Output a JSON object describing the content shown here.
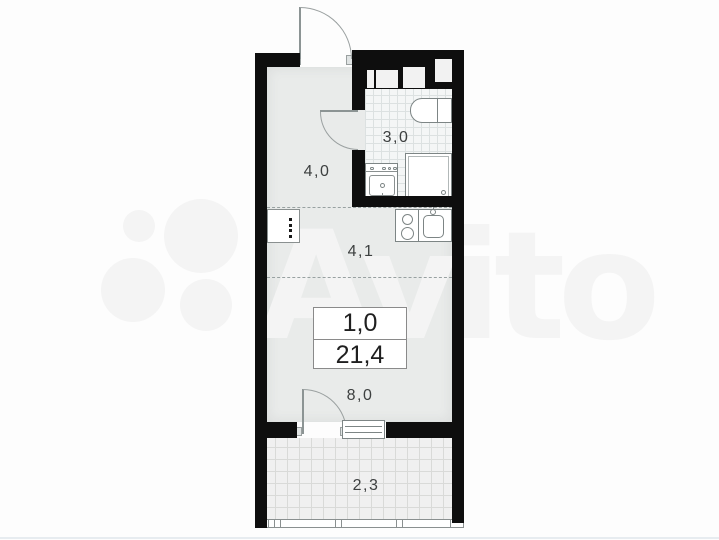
{
  "watermark": {
    "brand": "Avito"
  },
  "summary": {
    "rooms_count": "1,0",
    "total_area": "21,4"
  },
  "rooms": [
    {
      "id": "hallway",
      "area": "4,0"
    },
    {
      "id": "bathroom",
      "area": "3,0"
    },
    {
      "id": "kitchen",
      "area": "4,1"
    },
    {
      "id": "living-room",
      "area": "8,0"
    },
    {
      "id": "balcony",
      "area": "2,3"
    }
  ],
  "colors": {
    "wall": "#0e0e0e",
    "room_floor": "#e9ebea",
    "bathroom_tile": "#f4f6f6",
    "balcony_tile": "#f0f0f0",
    "watermark": "#f4f4f4"
  }
}
